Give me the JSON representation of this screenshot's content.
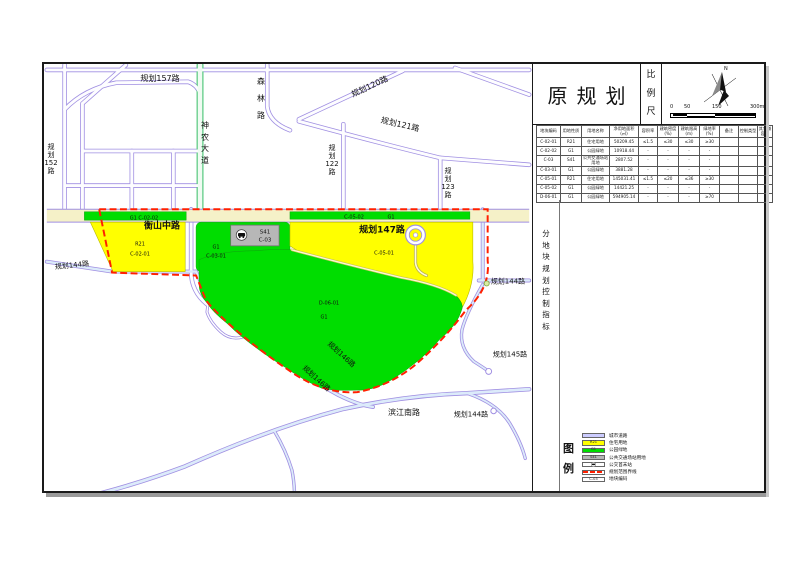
{
  "title_block": {
    "title": "原规划",
    "scale_label": "比例尺",
    "north": "N",
    "scale_ticks": [
      "0",
      "50",
      "150",
      "300m"
    ]
  },
  "side_label": "分地块规划控制指标",
  "table": {
    "headers": [
      "地块编码",
      "用地性质",
      "用地名称",
      "净用地面积(㎡)",
      "容积率",
      "建筑密度(%)",
      "建筑限高(m)",
      "绿地率(%)",
      "备注",
      "控制类型",
      "其它兼容性"
    ],
    "rows": [
      [
        "C-02-01",
        "R21",
        "住宅用地",
        "50209.45",
        "≤1.5",
        "≤30",
        "≤30",
        "≥30",
        "",
        "",
        ""
      ],
      [
        "C-02-02",
        "G1",
        "公园绿地",
        "10918.44",
        "-",
        "-",
        "-",
        "-",
        "",
        "",
        ""
      ],
      [
        "C-03",
        "S41",
        "公共交通场站用地",
        "2807.52",
        "-",
        "-",
        "-",
        "-",
        "",
        "",
        ""
      ],
      [
        "C-03-01",
        "G1",
        "公园绿地",
        "3881.28",
        "-",
        "-",
        "-",
        "-",
        "",
        "",
        ""
      ],
      [
        "C-05-01",
        "R21",
        "住宅用地",
        "145031.41",
        "≤1.5",
        "≤20",
        "≤36",
        "≥30",
        "",
        "",
        ""
      ],
      [
        "C-05-02",
        "G1",
        "公园绿地",
        "14421.25",
        "-",
        "-",
        "-",
        "-",
        "",
        "",
        ""
      ],
      [
        "D-06-01",
        "G1",
        "公园绿地",
        "594905.14",
        "-",
        "-",
        "-",
        "≥70",
        "",
        "",
        ""
      ]
    ]
  },
  "legend": {
    "title": "图例",
    "items": [
      {
        "swatch": "road",
        "code": "",
        "label": "城市道路"
      },
      {
        "swatch": "yellow",
        "code": "R21",
        "label": "住宅用地"
      },
      {
        "swatch": "green",
        "code": "G1",
        "label": "公园绿地"
      },
      {
        "swatch": "gray",
        "code": "S41",
        "label": "公共交通场站用地"
      },
      {
        "swatch": "bus",
        "code": "",
        "label": "公交首末站"
      },
      {
        "swatch": "redline",
        "code": "",
        "label": "规划范围界线"
      },
      {
        "swatch": "code",
        "code": "C-03",
        "label": "地块编码"
      }
    ]
  },
  "map": {
    "labels": [
      {
        "t": "规划157路",
        "x": 116,
        "y": 20,
        "s": 8
      },
      {
        "t": "神农大道",
        "x": 161,
        "y": 84,
        "s": 8,
        "v": 1,
        "g": 1.45
      },
      {
        "t": "森林路",
        "x": 217,
        "y": 40,
        "s": 8,
        "v": 1,
        "g": 2.1
      },
      {
        "t": "规划152路",
        "x": 7,
        "y": 100,
        "s": 7,
        "v": 1,
        "g": 1.15
      },
      {
        "t": "规划120路",
        "x": 326,
        "y": 28,
        "s": 8,
        "r": -25
      },
      {
        "t": "规划121路",
        "x": 356,
        "y": 66,
        "s": 8,
        "r": 13
      },
      {
        "t": "规划122路",
        "x": 288,
        "y": 101,
        "s": 7,
        "v": 1,
        "g": 1.15
      },
      {
        "t": "规划123路",
        "x": 404,
        "y": 124,
        "s": 7,
        "v": 1,
        "g": 1.15
      },
      {
        "t": "G1 C-02-02",
        "x": 100,
        "y": 160,
        "s": 5
      },
      {
        "t": "衡山中路",
        "x": 118,
        "y": 168,
        "s": 9,
        "b": 1
      },
      {
        "t": "C-05-02",
        "x": 310,
        "y": 159,
        "s": 5
      },
      {
        "t": "G1",
        "x": 347,
        "y": 159,
        "s": 5
      },
      {
        "t": "规划147路",
        "x": 338,
        "y": 172,
        "s": 9,
        "b": 1
      },
      {
        "t": "R21",
        "x": 96,
        "y": 186,
        "s": 5
      },
      {
        "t": "C-02-01",
        "x": 96,
        "y": 196,
        "s": 5
      },
      {
        "t": "规划144路",
        "x": 28,
        "y": 207,
        "s": 7,
        "r": -6
      },
      {
        "t": "G1",
        "x": 172,
        "y": 189,
        "s": 5
      },
      {
        "t": "C-03-01",
        "x": 172,
        "y": 198,
        "s": 5
      },
      {
        "t": "S41",
        "x": 221,
        "y": 174,
        "s": 5.5
      },
      {
        "t": "C-03",
        "x": 221,
        "y": 182,
        "s": 5.5
      },
      {
        "t": "C-05-01",
        "x": 340,
        "y": 195,
        "s": 5
      },
      {
        "t": "规划144路",
        "x": 464,
        "y": 223,
        "s": 7
      },
      {
        "t": "D-06-01",
        "x": 285,
        "y": 245,
        "s": 5
      },
      {
        "t": "G1",
        "x": 280,
        "y": 259,
        "s": 5
      },
      {
        "t": "规划146路",
        "x": 297,
        "y": 296,
        "s": 7,
        "r": 42
      },
      {
        "t": "规划146路",
        "x": 272,
        "y": 320,
        "s": 7,
        "r": 42
      },
      {
        "t": "规划145路",
        "x": 466,
        "y": 296,
        "s": 7
      },
      {
        "t": "滨江南路",
        "x": 360,
        "y": 354,
        "s": 8
      },
      {
        "t": "规划144路",
        "x": 427,
        "y": 356,
        "s": 7
      }
    ]
  },
  "colors": {
    "residential": "#ffff00",
    "green_space": "#00dd00",
    "transit_station": "#b7b7b7",
    "city_road_fill": "#ccccff",
    "road_casing": "#a08fe2",
    "boundary_red": "#ff2000",
    "avenue_green": "#53c87c"
  }
}
